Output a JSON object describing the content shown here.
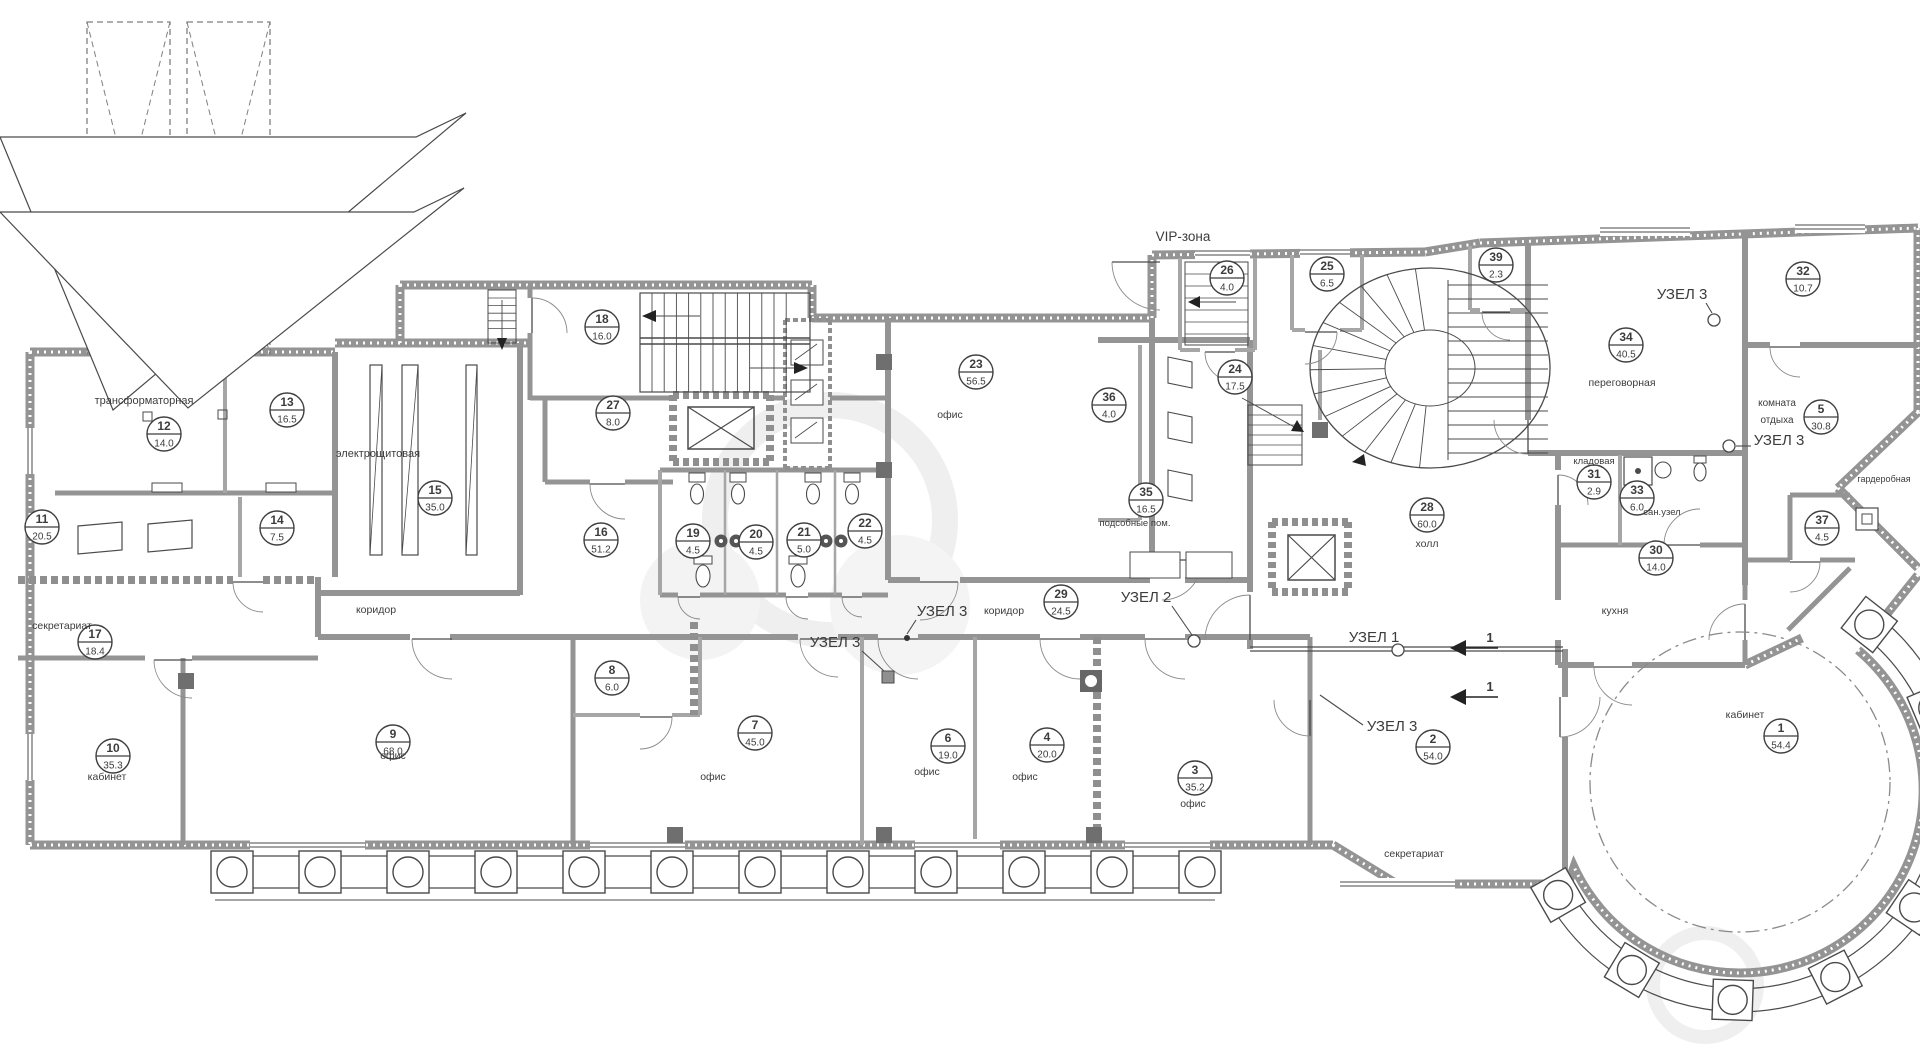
{
  "meta": {
    "type": "architectural-floor-plan",
    "language": "ru",
    "floor_note": "office floor plan with room numbers and areas in m2"
  },
  "colors": {
    "background": "#ffffff",
    "wall": "#949494",
    "wall_light": "#a6a6a6",
    "line": "#4a4a4a",
    "text": "#3c3c3c",
    "dark_fill": "#6f6f6f",
    "watermark": "#efefef"
  },
  "zone_label": {
    "t": "VIP-зона",
    "x": 1183,
    "y": 241,
    "s": 13.5
  },
  "rooms": [
    {
      "num": "1",
      "area": "54.4",
      "x": 1781,
      "y": 736
    },
    {
      "num": "2",
      "area": "54.0",
      "x": 1433,
      "y": 747
    },
    {
      "num": "3",
      "area": "35.2",
      "x": 1195,
      "y": 778
    },
    {
      "num": "4",
      "area": "20.0",
      "x": 1047,
      "y": 745
    },
    {
      "num": "5",
      "area": "30.8",
      "x": 1821,
      "y": 417
    },
    {
      "num": "6",
      "area": "19.0",
      "x": 948,
      "y": 746
    },
    {
      "num": "7",
      "area": "45.0",
      "x": 755,
      "y": 733
    },
    {
      "num": "8",
      "area": "6.0",
      "x": 612,
      "y": 678
    },
    {
      "num": "9",
      "area": "68.0",
      "x": 393,
      "y": 742
    },
    {
      "num": "10",
      "area": "35.3",
      "x": 113,
      "y": 756
    },
    {
      "num": "11",
      "area": "20.5",
      "x": 42,
      "y": 527
    },
    {
      "num": "12",
      "area": "14.0",
      "x": 164,
      "y": 434
    },
    {
      "num": "13",
      "area": "16.5",
      "x": 287,
      "y": 410
    },
    {
      "num": "14",
      "area": "7.5",
      "x": 277,
      "y": 528
    },
    {
      "num": "15",
      "area": "35.0",
      "x": 435,
      "y": 498
    },
    {
      "num": "16",
      "area": "51.2",
      "x": 601,
      "y": 540
    },
    {
      "num": "17",
      "area": "18.4",
      "x": 95,
      "y": 642
    },
    {
      "num": "18",
      "area": "16.0",
      "x": 602,
      "y": 327
    },
    {
      "num": "19",
      "area": "4.5",
      "x": 693,
      "y": 541
    },
    {
      "num": "20",
      "area": "4.5",
      "x": 756,
      "y": 542
    },
    {
      "num": "21",
      "area": "5.0",
      "x": 804,
      "y": 540
    },
    {
      "num": "22",
      "area": "4.5",
      "x": 865,
      "y": 531
    },
    {
      "num": "23",
      "area": "56.5",
      "x": 976,
      "y": 372
    },
    {
      "num": "24",
      "area": "17.5",
      "x": 1235,
      "y": 377
    },
    {
      "num": "25",
      "area": "6.5",
      "x": 1327,
      "y": 274
    },
    {
      "num": "26",
      "area": "4.0",
      "x": 1227,
      "y": 278
    },
    {
      "num": "27",
      "area": "8.0",
      "x": 613,
      "y": 413
    },
    {
      "num": "28",
      "area": "60.0",
      "x": 1427,
      "y": 515
    },
    {
      "num": "29",
      "area": "24.5",
      "x": 1061,
      "y": 602
    },
    {
      "num": "30",
      "area": "14.0",
      "x": 1656,
      "y": 558
    },
    {
      "num": "31",
      "area": "2.9",
      "x": 1594,
      "y": 482
    },
    {
      "num": "32",
      "area": "10.7",
      "x": 1803,
      "y": 279
    },
    {
      "num": "33",
      "area": "6.0",
      "x": 1637,
      "y": 498
    },
    {
      "num": "34",
      "area": "40.5",
      "x": 1626,
      "y": 345
    },
    {
      "num": "35",
      "area": "16.5",
      "x": 1146,
      "y": 500
    },
    {
      "num": "36",
      "area": "4.0",
      "x": 1109,
      "y": 405
    },
    {
      "num": "37",
      "area": "4.5",
      "x": 1822,
      "y": 528
    },
    {
      "num": "39",
      "area": "2.3",
      "x": 1496,
      "y": 265
    }
  ],
  "room_texts": [
    {
      "t": "трансформаторная",
      "x": 144,
      "y": 404,
      "s": 11
    },
    {
      "t": "электрощитовая",
      "x": 378,
      "y": 457,
      "s": 11
    },
    {
      "t": "секретариат",
      "x": 62,
      "y": 629,
      "s": 10.5
    },
    {
      "t": "коридор",
      "x": 376,
      "y": 613,
      "s": 10.5
    },
    {
      "t": "кабинет",
      "x": 107,
      "y": 780,
      "s": 10.5
    },
    {
      "t": "офис",
      "x": 393,
      "y": 759,
      "s": 10.5
    },
    {
      "t": "офис",
      "x": 713,
      "y": 780,
      "s": 10.5
    },
    {
      "t": "офис",
      "x": 927,
      "y": 775,
      "s": 10.5
    },
    {
      "t": "офис",
      "x": 1025,
      "y": 780,
      "s": 10.5
    },
    {
      "t": "офис",
      "x": 1193,
      "y": 807,
      "s": 10.5
    },
    {
      "t": "офис",
      "x": 950,
      "y": 418,
      "s": 10.5
    },
    {
      "t": "подсобные пом.",
      "x": 1135,
      "y": 526,
      "s": 9.5
    },
    {
      "t": "коридор",
      "x": 1004,
      "y": 614,
      "s": 10.5
    },
    {
      "t": "холл",
      "x": 1427,
      "y": 547,
      "s": 10.5
    },
    {
      "t": "переговорная",
      "x": 1622,
      "y": 386,
      "s": 10.5
    },
    {
      "t": "комната",
      "x": 1777,
      "y": 406,
      "s": 10
    },
    {
      "t": "отдыха",
      "x": 1777,
      "y": 423,
      "s": 10
    },
    {
      "t": "кладовая",
      "x": 1594,
      "y": 464,
      "s": 9.5
    },
    {
      "t": "сан.узел",
      "x": 1662,
      "y": 515,
      "s": 9.5
    },
    {
      "t": "гардеробная",
      "x": 1884,
      "y": 482,
      "s": 9
    },
    {
      "t": "кухня",
      "x": 1615,
      "y": 614,
      "s": 10.5
    },
    {
      "t": "кабинет",
      "x": 1745,
      "y": 718,
      "s": 10.5
    },
    {
      "t": "секретариат",
      "x": 1414,
      "y": 857,
      "s": 10.5
    }
  ],
  "node_labels": [
    {
      "t": "УЗЕЛ 3",
      "x": 942,
      "y": 616,
      "lx1": 916,
      "ly1": 620,
      "lx2": 907,
      "ly2": 634,
      "marker": "dot",
      "mx": 907,
      "my": 638
    },
    {
      "t": "УЗЕЛ 3",
      "x": 835,
      "y": 647,
      "lx1": 862,
      "ly1": 651,
      "lx2": 884,
      "ly2": 671,
      "marker": "square",
      "mx": 888,
      "my": 677
    },
    {
      "t": "УЗЕЛ 2",
      "x": 1146,
      "y": 602,
      "lx1": 1172,
      "ly1": 606,
      "lx2": 1192,
      "ly2": 635,
      "marker": "circle",
      "mx": 1194,
      "my": 641
    },
    {
      "t": "УЗЕЛ 1",
      "x": 1374,
      "y": 642,
      "lx1": 1398,
      "ly1": 644,
      "lx2": 1398,
      "ly2": 646,
      "marker": "circle",
      "mx": 1398,
      "my": 650
    },
    {
      "t": "УЗЕЛ 3",
      "x": 1392,
      "y": 731,
      "lx1": 1363,
      "ly1": 725,
      "lx2": 1320,
      "ly2": 695,
      "marker": "none",
      "mx": 0,
      "my": 0
    },
    {
      "t": "УЗЕЛ 3",
      "x": 1682,
      "y": 299,
      "lx1": 1706,
      "ly1": 303,
      "lx2": 1712,
      "ly2": 313,
      "marker": "circle",
      "mx": 1714,
      "my": 320
    },
    {
      "t": "УЗЕЛ 3",
      "x": 1779,
      "y": 445,
      "lx1": 1751,
      "ly1": 446,
      "lx2": 1736,
      "ly2": 446,
      "marker": "circle",
      "mx": 1729,
      "my": 446
    }
  ],
  "section_marks": [
    {
      "t": "1",
      "x": 1460,
      "y": 648
    },
    {
      "t": "1",
      "x": 1460,
      "y": 697
    }
  ]
}
